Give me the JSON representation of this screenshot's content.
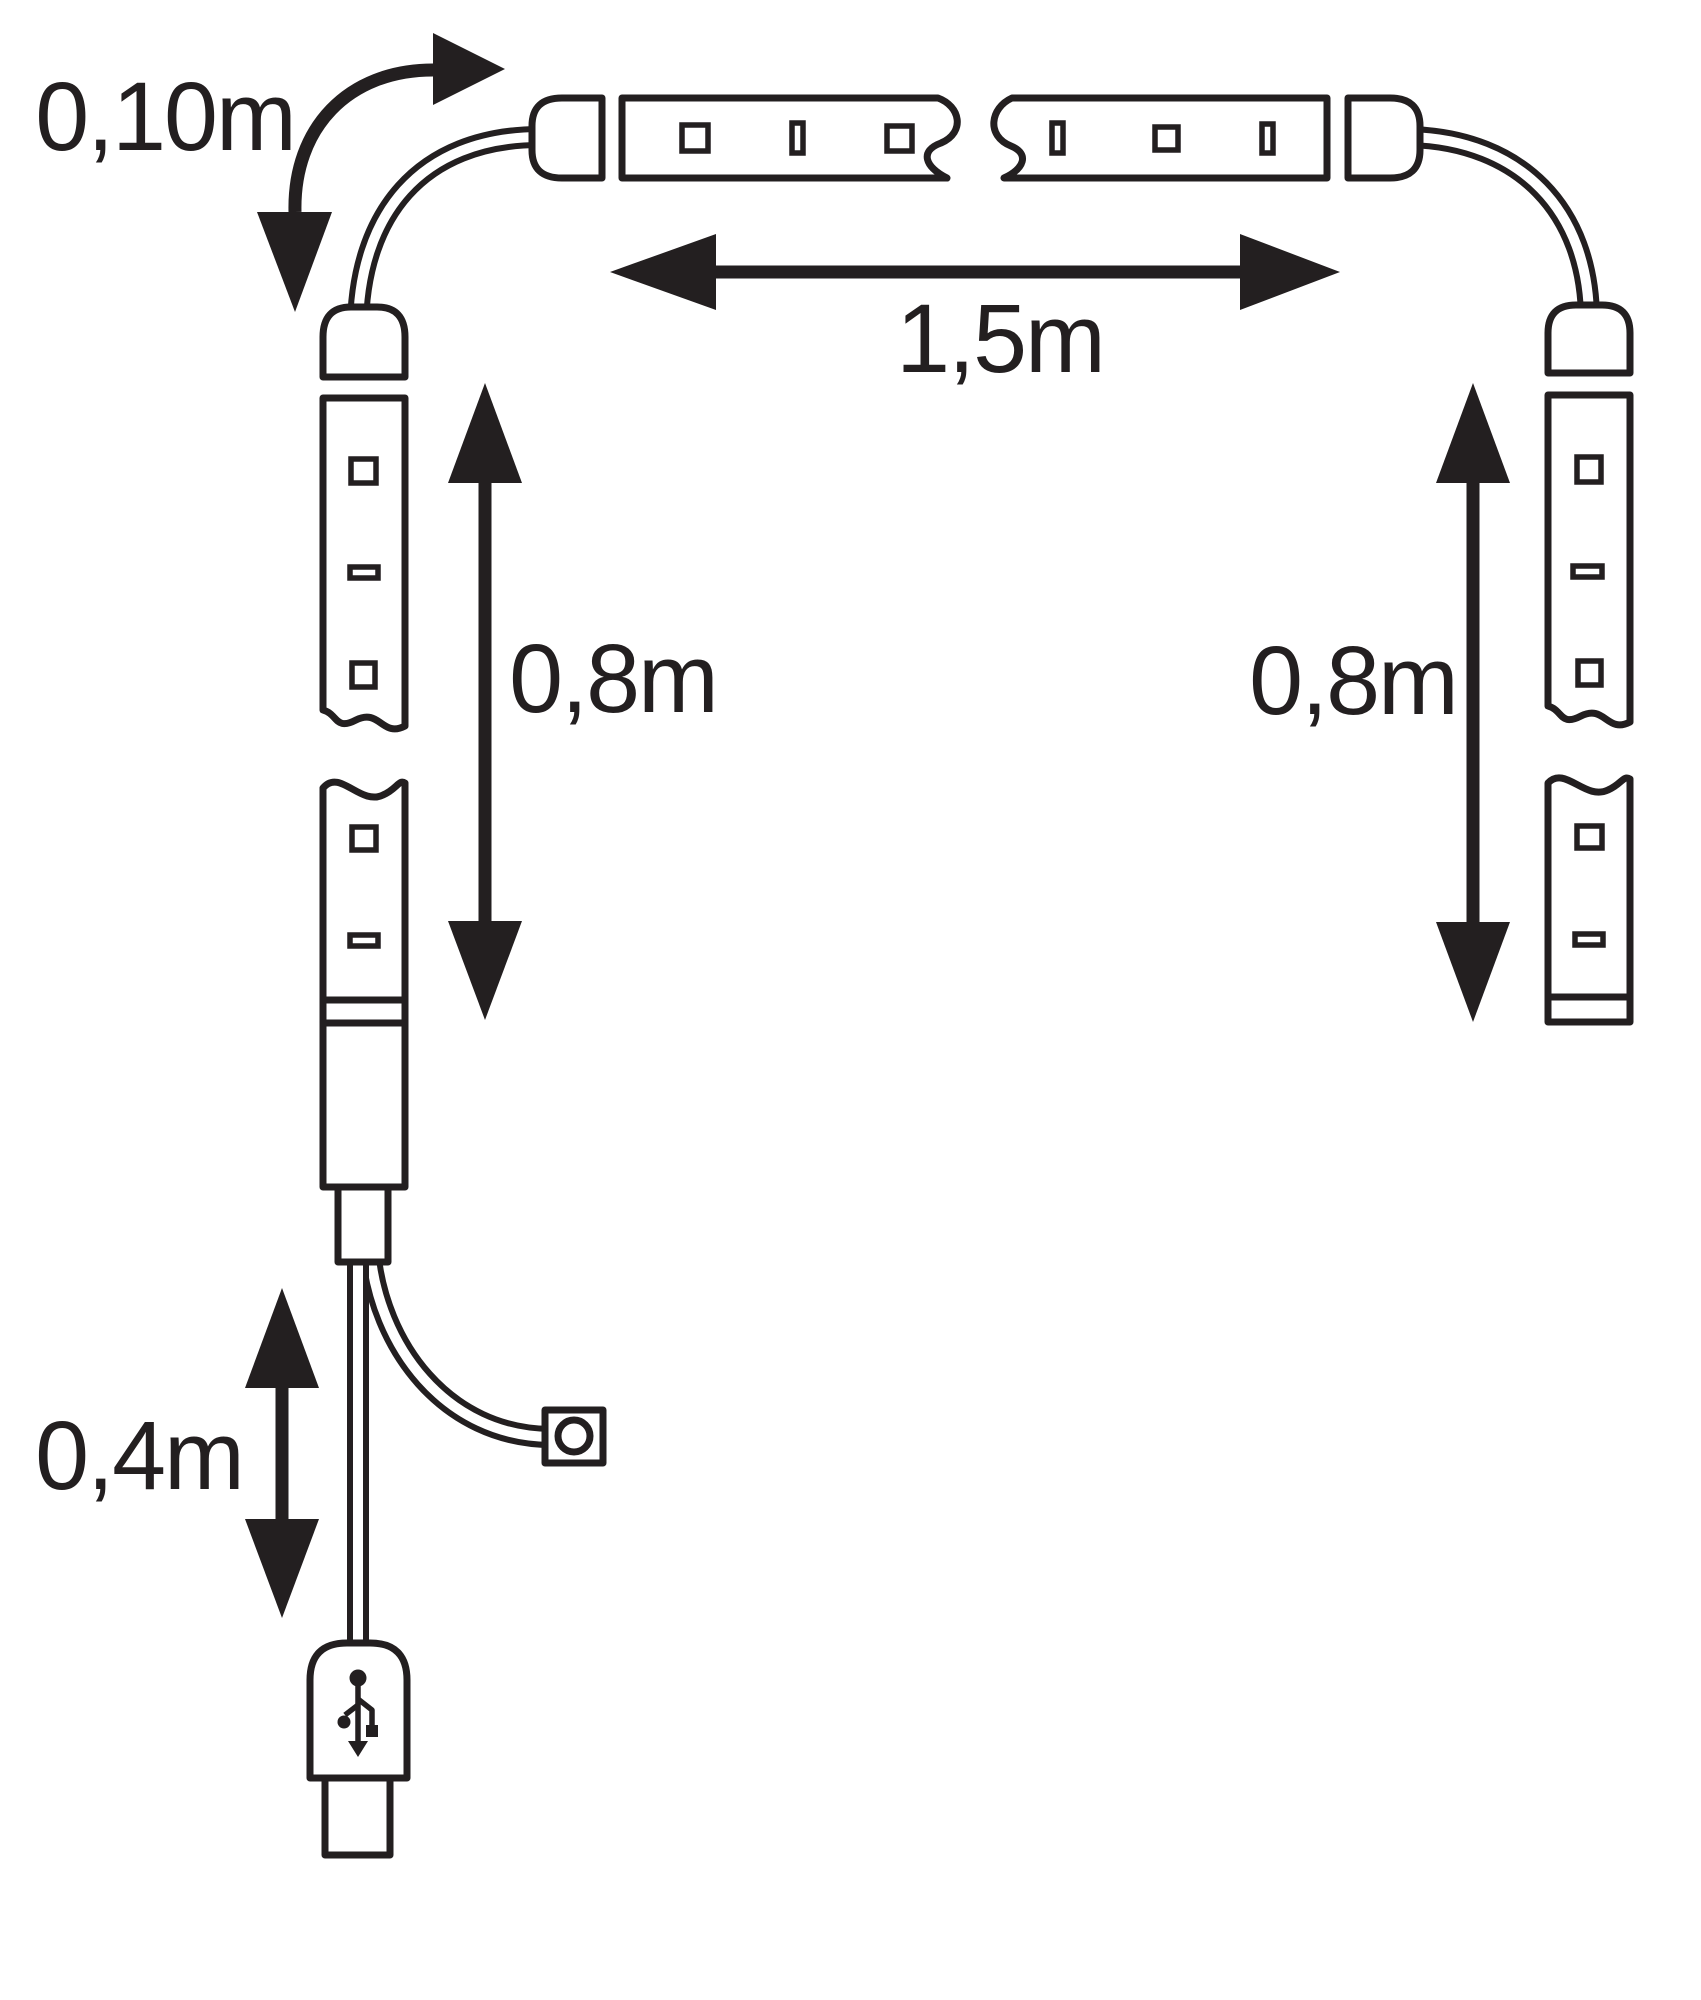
{
  "diagram": {
    "background_color": "#ffffff",
    "ink_color": "#231f20",
    "dimension_labels": {
      "connector_cable": "0,10m",
      "top_strip": "1,5m",
      "left_strip": "0,8m",
      "right_strip": "0,8m",
      "usb_cable": "0,4m"
    },
    "icons": {
      "usb": "usb-trident-icon",
      "switch": "round-switch-icon"
    }
  }
}
